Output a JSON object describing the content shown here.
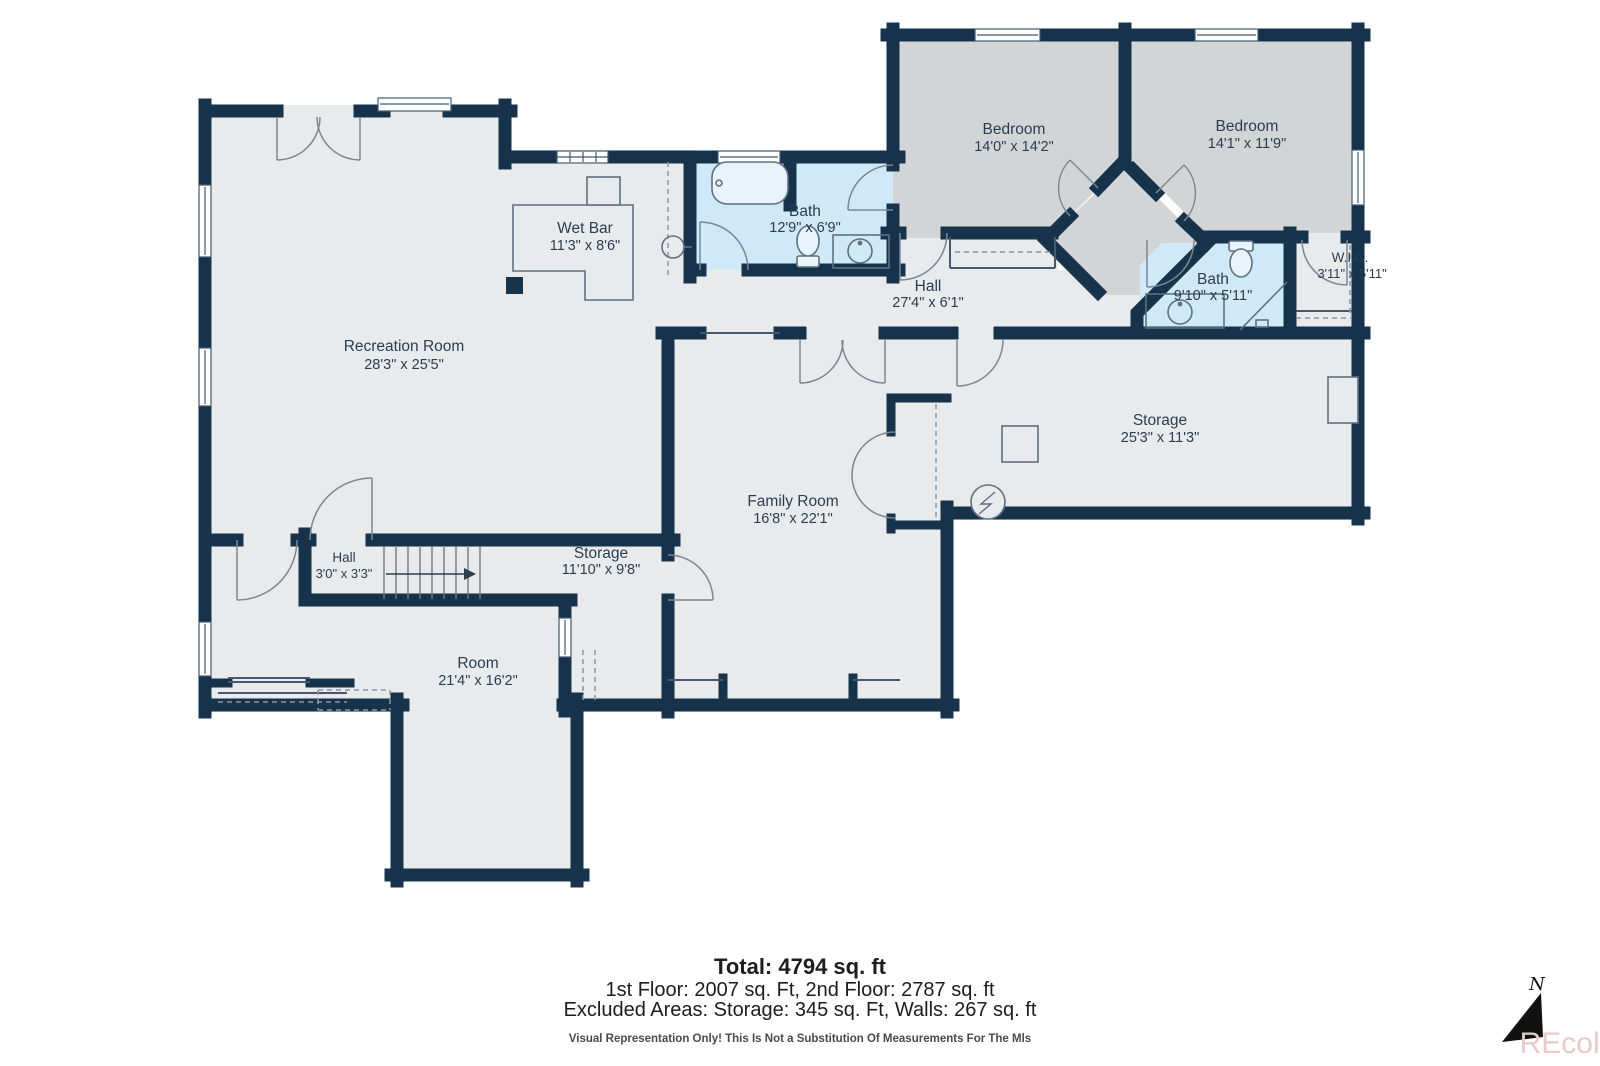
{
  "plan": {
    "colors": {
      "wall": "#16334b",
      "floor": "#e9eaeb",
      "bedroom_floor": "#d3d4d6",
      "bath_floor": "#cfe9f7",
      "label_text": "#2a3e53",
      "watermark": "#e6cbca"
    }
  },
  "rooms": [
    {
      "id": "recreation-room",
      "name": "Recreation Room",
      "dims": "28'3\" x 25'5\""
    },
    {
      "id": "wet-bar",
      "name": "Wet Bar",
      "dims": "11'3\" x 8'6\""
    },
    {
      "id": "bath-main",
      "name": "Bath",
      "dims": "12'9\" x 6'9\""
    },
    {
      "id": "bedroom-1",
      "name": "Bedroom",
      "dims": "14'0\" x 14'2\""
    },
    {
      "id": "bedroom-2",
      "name": "Bedroom",
      "dims": "14'1\" x 11'9\""
    },
    {
      "id": "hall-main",
      "name": "Hall",
      "dims": "27'4\" x 6'1\""
    },
    {
      "id": "bath-2",
      "name": "Bath",
      "dims": "9'10\" x 5'11\""
    },
    {
      "id": "wic",
      "name": "W.I.C.",
      "dims": "3'11\" x 5'11\""
    },
    {
      "id": "storage-1",
      "name": "Storage",
      "dims": "25'3\" x 11'3\""
    },
    {
      "id": "family-room",
      "name": "Family Room",
      "dims": "16'8\" x 22'1\""
    },
    {
      "id": "hall-2",
      "name": "Hall",
      "dims": "3'0\" x 3'3\""
    },
    {
      "id": "storage-2",
      "name": "Storage",
      "dims": "11'10\" x 9'8\""
    },
    {
      "id": "room",
      "name": "Room",
      "dims": "21'4\" x 16'2\""
    }
  ],
  "summary": {
    "total": "Total: 4794 sq. ft",
    "floors": "1st Floor: 2007 sq. Ft, 2nd Floor: 2787 sq. ft",
    "excluded": "Excluded Areas: Storage: 345 sq. Ft, Walls: 267 sq. ft",
    "disclaimer": "Visual Representation Only! This Is Not a Substitution Of Measurements For The Mls"
  },
  "compass": {
    "north_label": "N"
  },
  "watermark": {
    "text": "REcolorado"
  }
}
